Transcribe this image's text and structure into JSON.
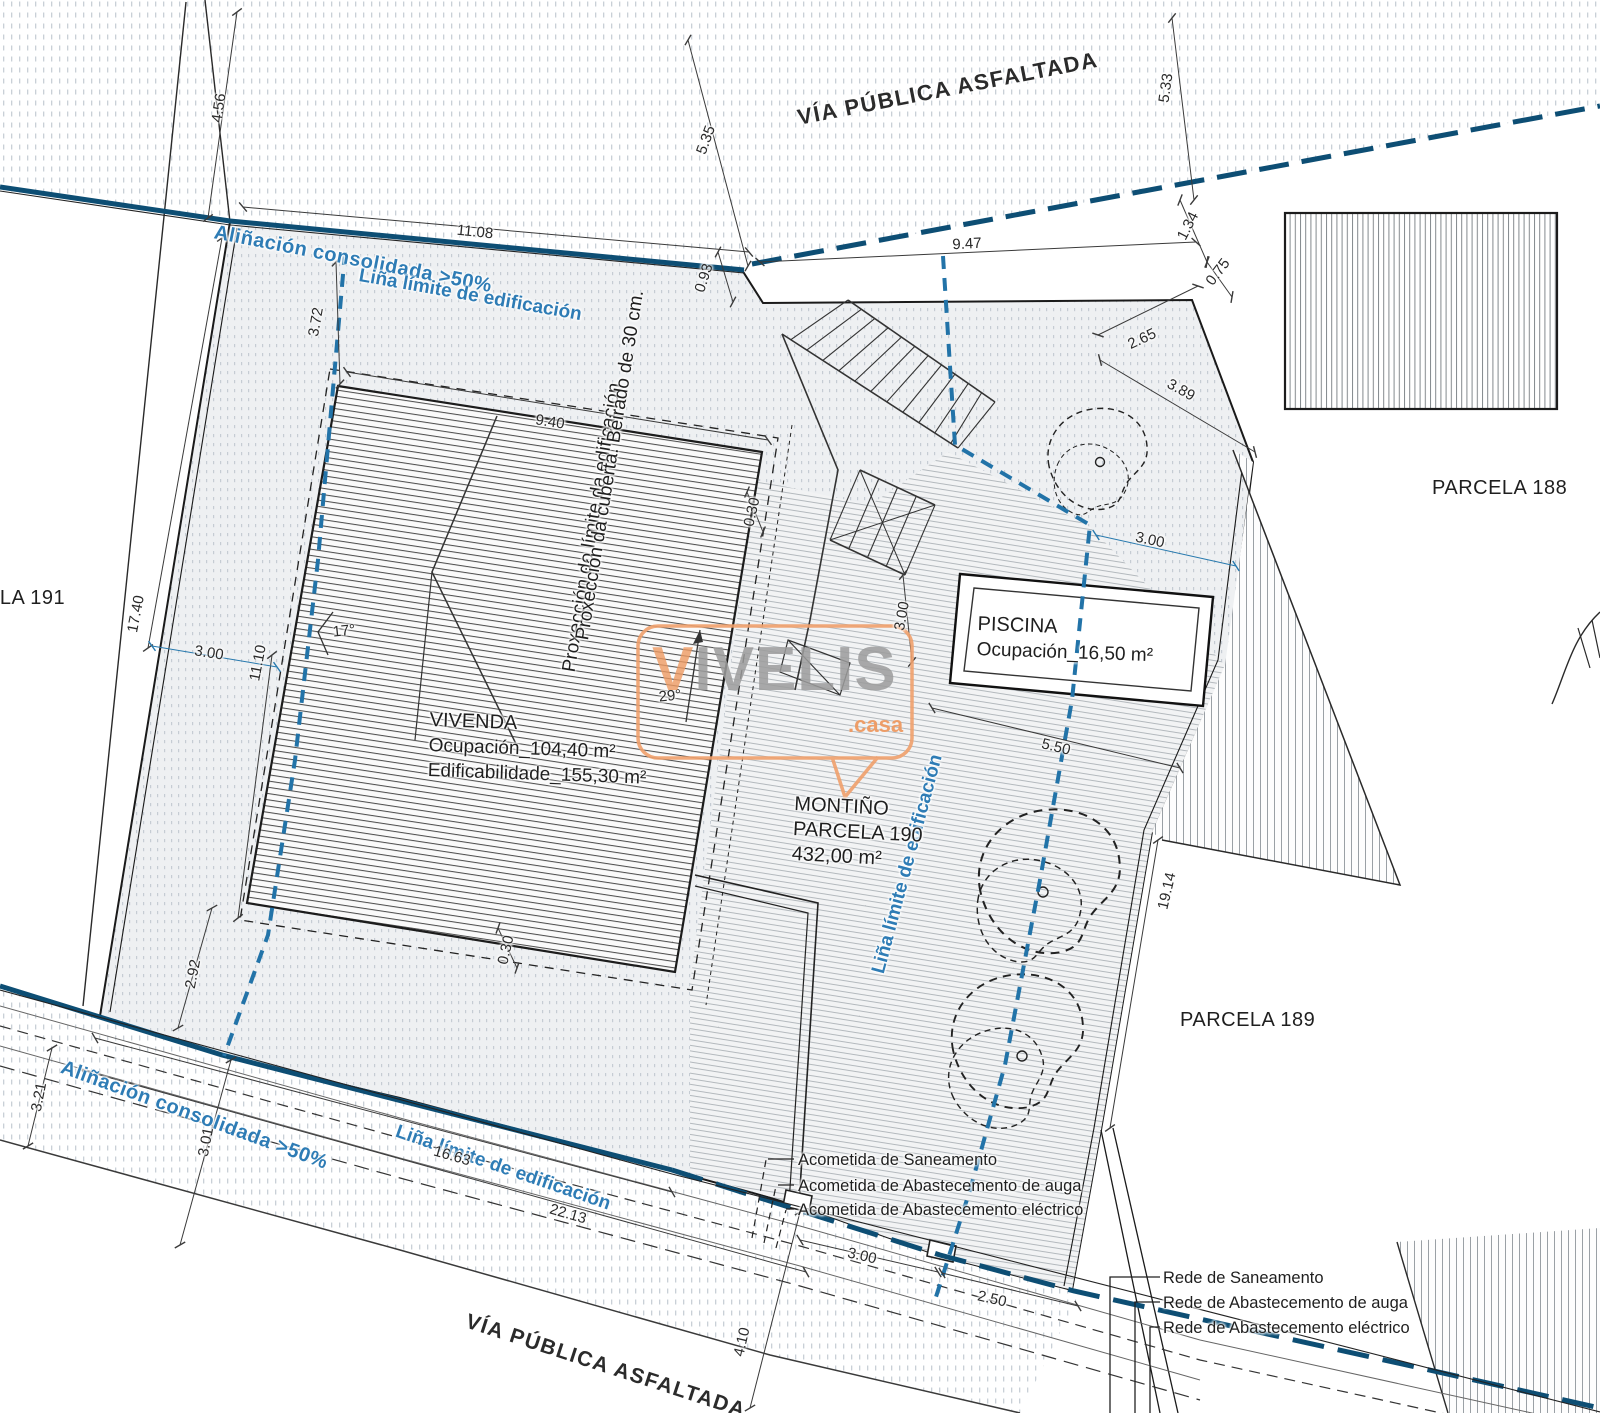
{
  "roads": {
    "top": "VÍA PÚBLICA ASFALTADA",
    "bottom": "VÍA PÚBLICA ASFALTADA"
  },
  "parcels": {
    "p188": "PARCELA 188",
    "p189": "PARCELA 189",
    "p190_name": "MONTIÑO",
    "p190_ref": "PARCELA 190",
    "p190_area": "432,00 m²",
    "p191_partial": "ELA 191"
  },
  "vivenda": {
    "name": "VIVENDA",
    "ocupacion": "Ocupación_104,40 m²",
    "edificabilidade": "Edificabilidade_155,30 m²"
  },
  "piscina": {
    "name": "PISCINA",
    "ocupacion": "Ocupación_16,50 m²"
  },
  "blue_lines": {
    "alinacion_top": "Aliñación consolidada >50%",
    "lina_top": "Liña límite de edificación",
    "alinacion_bottom": "Aliñación consolidada >50%",
    "lina_bottom": "Liña límite de edificación",
    "lina_right": "Liña límite de edificación"
  },
  "projections": {
    "limite": "Proxección do límite da edificación",
    "cuberta": "Proxección da cuberta. Beirado de 30 cm."
  },
  "acometidas": [
    "Acometida de Saneamento",
    "Acometida de Abastecemento de auga",
    "Acometida de Abastecemento eléctrico"
  ],
  "redes": [
    "Rede de Saneamento",
    "Rede de Abastecemento de auga",
    "Rede de Abastecemento eléctrico"
  ],
  "watermark": {
    "brand_v": "V",
    "brand_rest": "IVELIS",
    "suffix": ".casa"
  },
  "colors": {
    "alinacion_blue": "#0d4e74",
    "limite_blue": "#2273a8",
    "blue_text": "#2e7cb5",
    "watermark_orange": "#ee9a62"
  },
  "dimensions": [
    {
      "v": "4.56",
      "x": 219,
      "y": 108,
      "r": -82
    },
    {
      "v": "5.35",
      "x": 706,
      "y": 140,
      "r": -70
    },
    {
      "v": "5.33",
      "x": 1166,
      "y": 88,
      "r": -82
    },
    {
      "v": "11.08",
      "x": 475,
      "y": 232,
      "r": 6
    },
    {
      "v": "0.93",
      "x": 704,
      "y": 278,
      "r": -72
    },
    {
      "v": "9.47",
      "x": 967,
      "y": 244,
      "r": -3
    },
    {
      "v": "1.34",
      "x": 1188,
      "y": 226,
      "r": -63
    },
    {
      "v": "0.75",
      "x": 1218,
      "y": 272,
      "r": -53
    },
    {
      "v": "2.65",
      "x": 1142,
      "y": 339,
      "r": -25
    },
    {
      "v": "3.89",
      "x": 1181,
      "y": 390,
      "r": 29
    },
    {
      "v": "3.00",
      "x": 1150,
      "y": 540,
      "r": 12
    },
    {
      "v": "3.72",
      "x": 316,
      "y": 322,
      "r": -80
    },
    {
      "v": "9.40",
      "x": 550,
      "y": 422,
      "r": 9
    },
    {
      "v": "0.30",
      "x": 752,
      "y": 512,
      "r": -77
    },
    {
      "v": "3.00",
      "x": 902,
      "y": 616,
      "r": -80
    },
    {
      "v": "17.40",
      "x": 136,
      "y": 614,
      "r": -79
    },
    {
      "v": "3.00",
      "x": 209,
      "y": 653,
      "r": 9
    },
    {
      "v": "11.10",
      "x": 258,
      "y": 663,
      "r": -79
    },
    {
      "v": "2.92",
      "x": 193,
      "y": 974,
      "r": -79
    },
    {
      "v": "0.30",
      "x": 506,
      "y": 950,
      "r": -77
    },
    {
      "v": "3.21",
      "x": 39,
      "y": 1097,
      "r": -79
    },
    {
      "v": "3.01",
      "x": 206,
      "y": 1142,
      "r": -79
    },
    {
      "v": "16.63",
      "x": 452,
      "y": 1156,
      "r": 16
    },
    {
      "v": "22.13",
      "x": 568,
      "y": 1214,
      "r": 16
    },
    {
      "v": "4.10",
      "x": 742,
      "y": 1342,
      "r": -77
    },
    {
      "v": "3.00",
      "x": 862,
      "y": 1256,
      "r": 13
    },
    {
      "v": "2.50",
      "x": 992,
      "y": 1299,
      "r": 13
    },
    {
      "v": "5.50",
      "x": 1056,
      "y": 747,
      "r": 14
    },
    {
      "v": "19.14",
      "x": 1167,
      "y": 891,
      "r": -77
    },
    {
      "v": "17°",
      "x": 344,
      "y": 631,
      "r": -6
    },
    {
      "v": "29°",
      "x": 670,
      "y": 696,
      "r": -6
    }
  ]
}
